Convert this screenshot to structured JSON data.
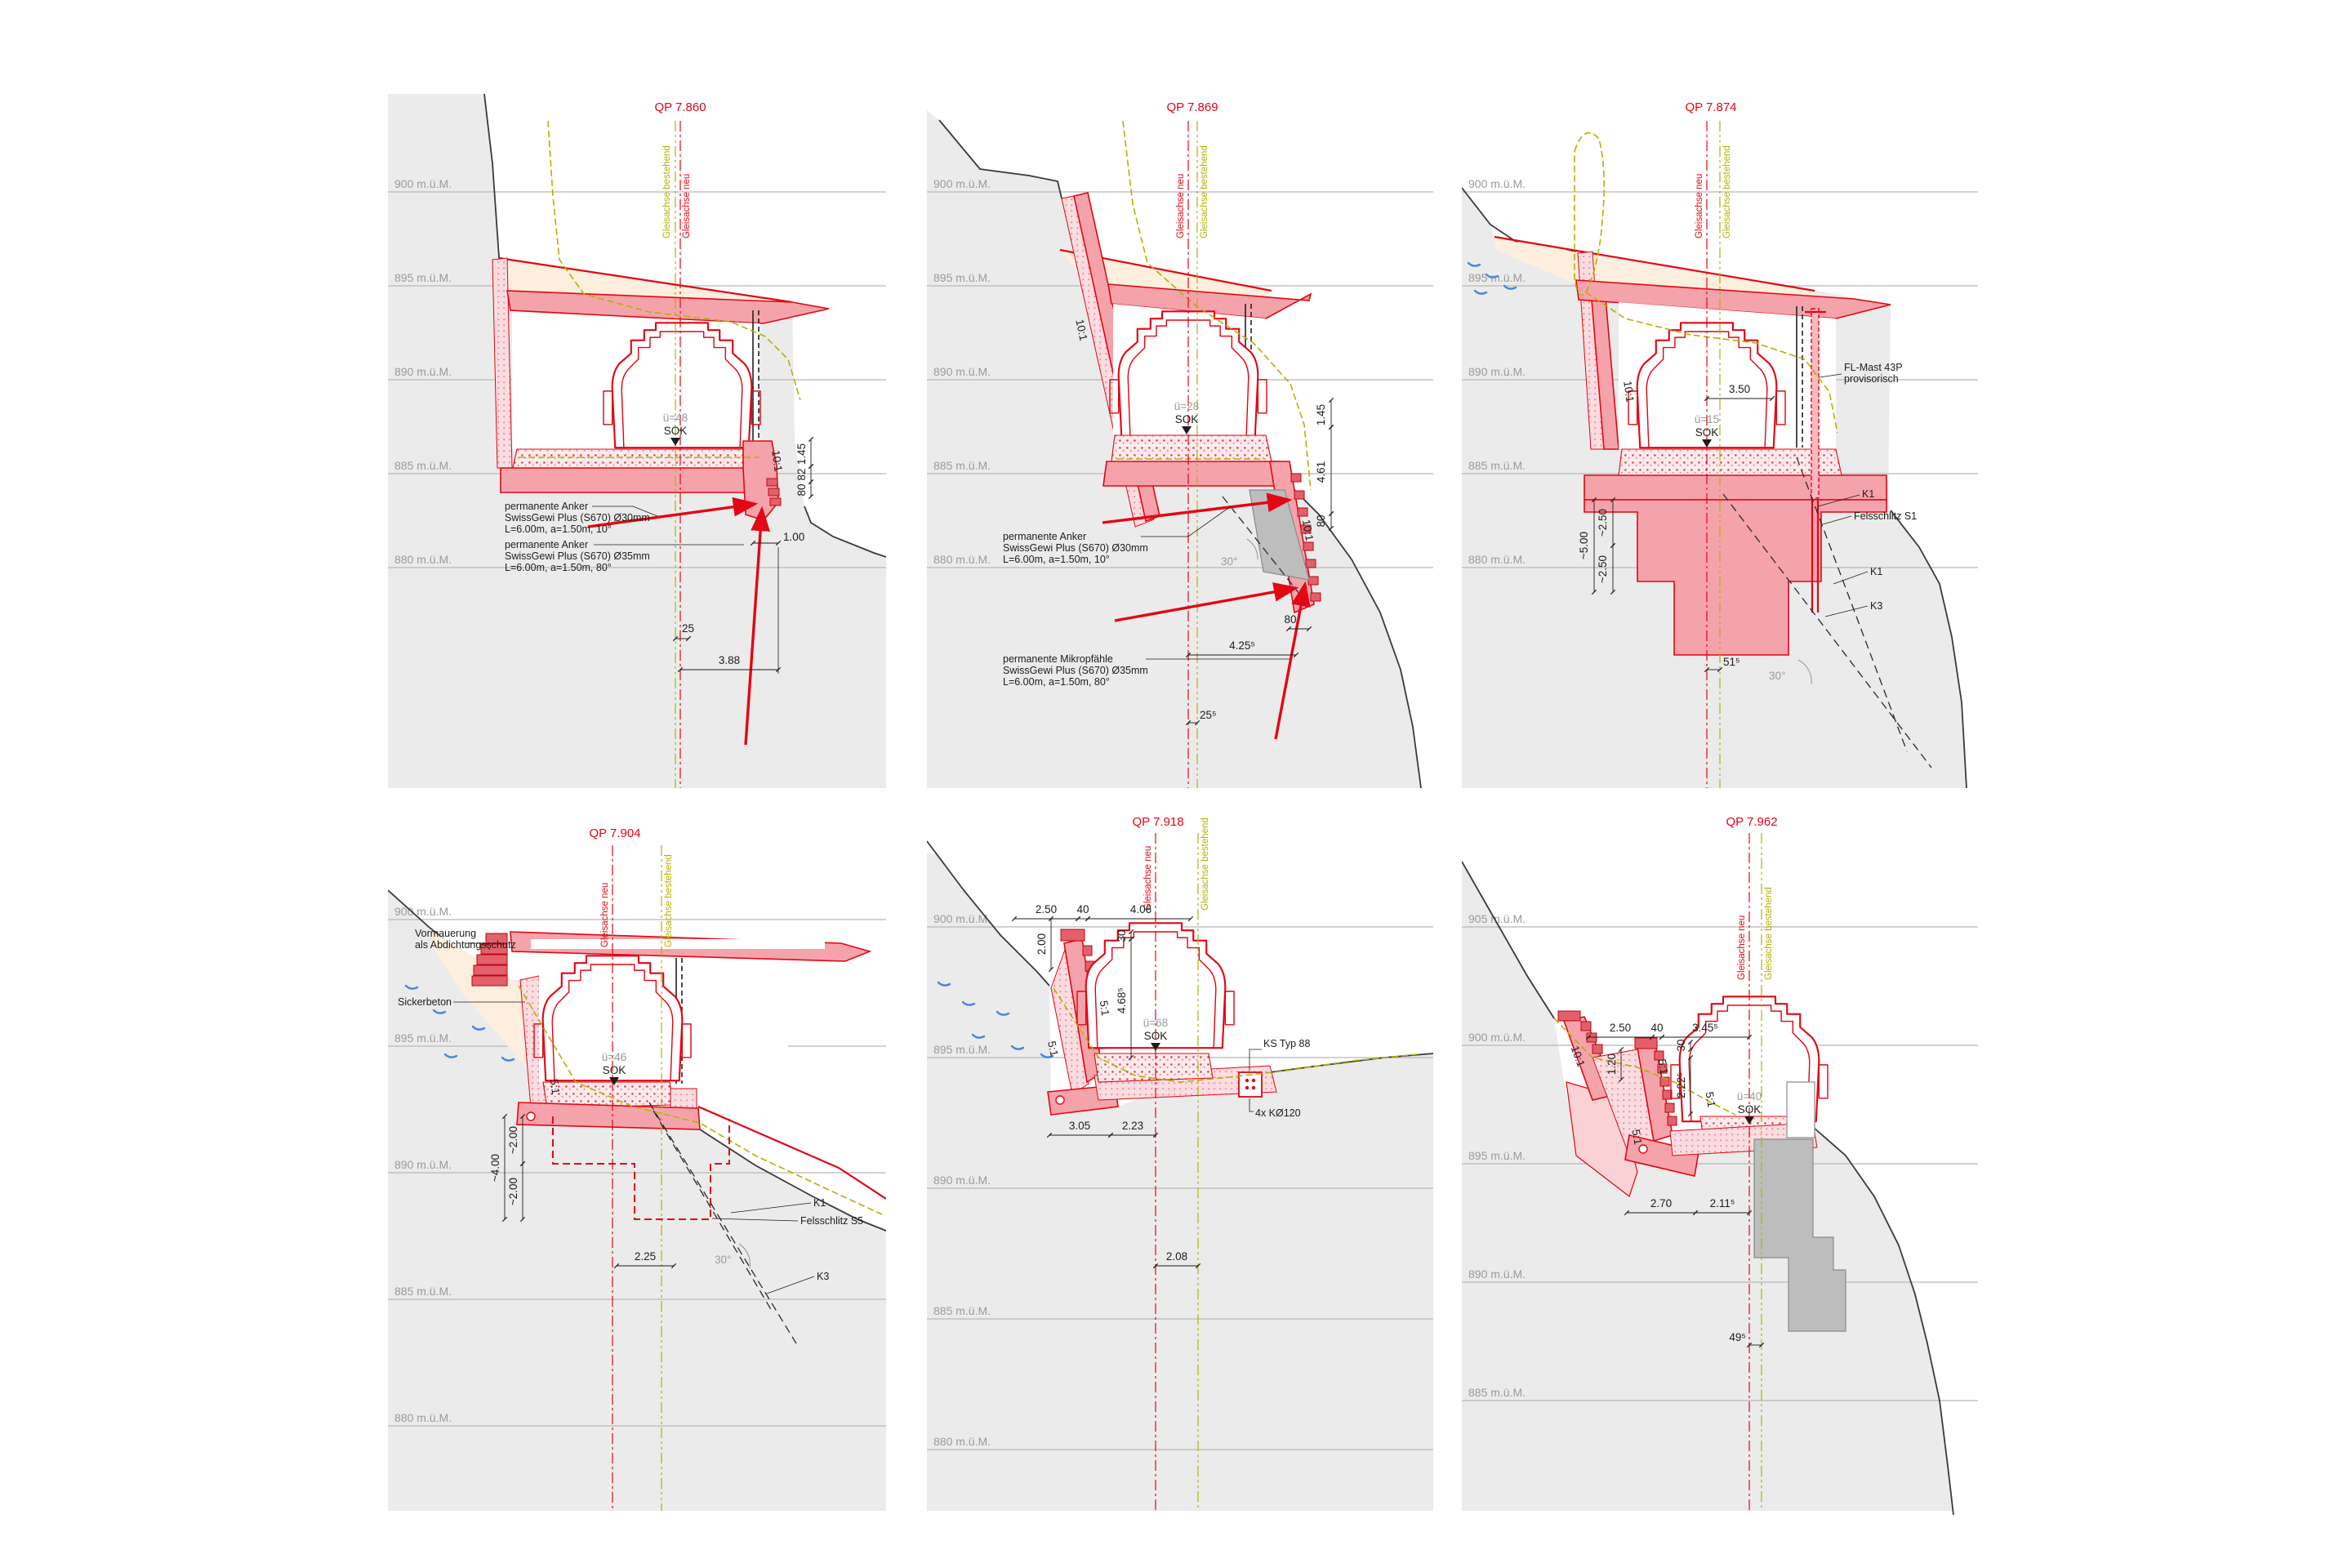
{
  "axis": {
    "neu": "Gleisachse neu",
    "best": "Gleisachse bestehend"
  },
  "panels": [
    {
      "title": "QP 7.860",
      "elev": [
        "900 m.ü.M.",
        "895 m.ü.M.",
        "890 m.ü.M.",
        "885 m.ü.M.",
        "880 m.ü.M."
      ],
      "train": "ü=48",
      "sok": "SOK",
      "slopes": [
        "10:1"
      ],
      "dims": [
        "1.45",
        "82",
        "80",
        "1.00",
        "25",
        "3.88"
      ],
      "ann1": [
        "permanente Anker",
        "SwissGewi Plus (S670) Ø30mm",
        "L=6.00m, a=1.50m, 10°"
      ],
      "ann2": [
        "permanente Anker",
        "SwissGewi Plus (S670) Ø35mm",
        "L=6.00m, a=1.50m, 80°"
      ]
    },
    {
      "title": "QP 7.869",
      "elev": [
        "900 m.ü.M.",
        "895 m.ü.M.",
        "890 m.ü.M.",
        "885 m.ü.M.",
        "880 m.ü.M."
      ],
      "train": "ü=28",
      "sok": "SOK",
      "slopes": [
        "10:1",
        "10:1"
      ],
      "angle": "30°",
      "dims": [
        "1.45",
        "4.61",
        "80",
        "80",
        "4.25⁵",
        "25⁵"
      ],
      "ann1": [
        "permanente Anker",
        "SwissGewi Plus (S670) Ø30mm",
        "L=6.00m, a=1.50m, 10°"
      ],
      "ann2": [
        "permanente Mikropfähle",
        "SwissGewi Plus (S670) Ø35mm",
        "L=6.00m, a=1.50m, 80°"
      ]
    },
    {
      "title": "QP 7.874",
      "elev": [
        "900 m.ü.M.",
        "895 m.ü.M.",
        "890 m.ü.M.",
        "885 m.ü.M.",
        "880 m.ü.M."
      ],
      "train": "ü=15",
      "sok": "SOK",
      "slopes": [
        "10:1"
      ],
      "angle": "30°",
      "dims": [
        "3.50",
        "~5.00",
        "~2.50",
        "~2.50",
        "51⁵"
      ],
      "labels": [
        "FL-Mast 43P",
        "provisorisch",
        "K1",
        "Felsschlitz S1",
        "K1",
        "K3"
      ]
    },
    {
      "title": "QP 7.904",
      "elev": [
        "900 m.ü.M.",
        "895 m.ü.M.",
        "890 m.ü.M.",
        "885 m.ü.M.",
        "880 m.ü.M."
      ],
      "train": "ü=46",
      "sok": "SOK",
      "slopes": [
        "5:1"
      ],
      "angle": "30°",
      "dims": [
        "~4.00",
        "~2.00",
        "~2.00",
        "2.25"
      ],
      "labels": [
        "Vormauerung",
        "als Abdichtungsschutz",
        "Sickerbeton",
        "K1",
        "Felsschlitz S5",
        "K3"
      ]
    },
    {
      "title": "QP 7.918",
      "elev": [
        "900 m.ü.M.",
        "895 m.ü.M.",
        "890 m.ü.M.",
        "885 m.ü.M.",
        "880 m.ü.M."
      ],
      "train": "ü=68",
      "sok": "SOK",
      "slopes": [
        "5:1",
        "5:1"
      ],
      "dims": [
        "2.50",
        "40",
        "4.06",
        "2.00",
        "30",
        "4.68⁵",
        "3.05",
        "2.23",
        "2.08"
      ],
      "labels": [
        "KS Typ 88",
        "4x KØ120"
      ]
    },
    {
      "title": "QP 7.962",
      "elev": [
        "905 m.ü.M.",
        "900 m.ü.M.",
        "895 m.ü.M.",
        "890 m.ü.M.",
        "885 m.ü.M."
      ],
      "train": "ü=40",
      "sok": "SOK",
      "slopes": [
        "10:1",
        "5:1",
        "5:1",
        "5:1"
      ],
      "dims": [
        "2.50",
        "40",
        "3.45⁵",
        "1.20",
        "2.22⁵",
        "30",
        "2.70",
        "2.11⁵",
        "49⁵"
      ]
    }
  ]
}
